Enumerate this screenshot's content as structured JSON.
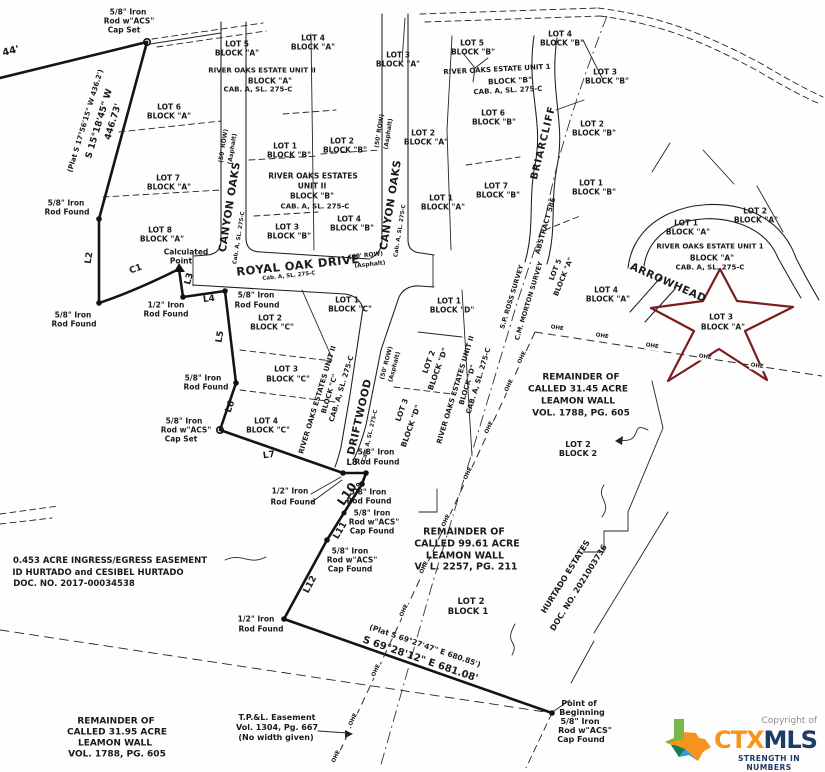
{
  "map": {
    "title": "River Oaks Estates subdivision survey plat",
    "colors": {
      "ink": "#1a1a1a",
      "paper": "#fefefe",
      "star_red": "#7b1c1f",
      "logo_orange": "#f7941e",
      "logo_navy": "#1e3c68",
      "logo_green": "#7ab648",
      "logo_teal": "#177b57",
      "logo_blue": "#2a9fd8",
      "copyright_gray": "#8d8d8d"
    },
    "logo": {
      "copyright": "Copyright of",
      "ctx": "CTX",
      "mls": "MLS",
      "tagline": "STRENGTH IN NUMBERS"
    },
    "labels": [
      {
        "t": "5/8\" Iron",
        "x": 128,
        "y": 12
      },
      {
        "t": "Rod w\"ACS\"",
        "x": 129,
        "y": 21
      },
      {
        "t": "Cap Set",
        "x": 124,
        "y": 30
      },
      {
        "t": "44'",
        "x": 11,
        "y": 52,
        "r": -14,
        "s": 10
      },
      {
        "t": "(Plat S 17°56'15\" W 436.2')",
        "x": 86,
        "y": 121,
        "r": -73,
        "s": 7
      },
      {
        "t": "S 15°18'45\" W",
        "x": 100,
        "y": 124,
        "r": -73,
        "s": 9
      },
      {
        "t": "446.73'",
        "x": 114,
        "y": 122,
        "r": -73,
        "s": 9
      },
      {
        "t": "5/8\" Iron",
        "x": 66,
        "y": 203
      },
      {
        "t": "Rod Found",
        "x": 67,
        "y": 212
      },
      {
        "t": "L2",
        "x": 90,
        "y": 258,
        "r": -82,
        "s": 9
      },
      {
        "t": "5/8\" Iron",
        "x": 73,
        "y": 315
      },
      {
        "t": "Rod Found",
        "x": 74,
        "y": 324
      },
      {
        "t": "C1",
        "x": 136,
        "y": 270,
        "r": -20,
        "s": 9
      },
      {
        "t": "Calculated",
        "x": 186,
        "y": 252
      },
      {
        "t": "Point",
        "x": 181,
        "y": 261
      },
      {
        "t": "L3",
        "x": 190,
        "y": 279,
        "r": -75,
        "s": 9
      },
      {
        "t": "1/2\" Iron",
        "x": 166,
        "y": 305
      },
      {
        "t": "Rod Found",
        "x": 166,
        "y": 314
      },
      {
        "t": "L4",
        "x": 209,
        "y": 300,
        "r": -6,
        "s": 9
      },
      {
        "t": "5/8\" Iron",
        "x": 256,
        "y": 295
      },
      {
        "t": "Rod Found",
        "x": 257,
        "y": 305
      },
      {
        "t": "L5",
        "x": 221,
        "y": 337,
        "r": -80,
        "s": 9
      },
      {
        "t": "5/8\" Iron",
        "x": 203,
        "y": 378
      },
      {
        "t": "Rod Found",
        "x": 206,
        "y": 387
      },
      {
        "t": "L6",
        "x": 231,
        "y": 407,
        "r": -70,
        "s": 9
      },
      {
        "t": "5/8\" Iron",
        "x": 184,
        "y": 421
      },
      {
        "t": "Rod w\"ACS\"",
        "x": 186,
        "y": 430
      },
      {
        "t": "Cap Set",
        "x": 181,
        "y": 439
      },
      {
        "t": "L7",
        "x": 269,
        "y": 456,
        "r": -8,
        "s": 9
      },
      {
        "t": "LOT 5",
        "x": 237,
        "y": 44
      },
      {
        "t": "BLOCK \"A\"",
        "x": 237,
        "y": 53
      },
      {
        "t": "LOT 6",
        "x": 169,
        "y": 107
      },
      {
        "t": "BLOCK \"A\"",
        "x": 169,
        "y": 116
      },
      {
        "t": "LOT 7",
        "x": 168,
        "y": 178
      },
      {
        "t": "BLOCK \"A\"",
        "x": 169,
        "y": 187
      },
      {
        "t": "LOT 8",
        "x": 160,
        "y": 230
      },
      {
        "t": "BLOCK \"A\"",
        "x": 162,
        "y": 239
      },
      {
        "t": "RIVER OAKS ESTATE UNIT II",
        "x": 262,
        "y": 71,
        "s": 7
      },
      {
        "t": "BLOCK \"A\"",
        "x": 270,
        "y": 81
      },
      {
        "t": "CAB. A, SL. 275-C",
        "x": 258,
        "y": 90,
        "s": 7
      },
      {
        "t": "LOT 4",
        "x": 313,
        "y": 38
      },
      {
        "t": "BLOCK \"A\"",
        "x": 313,
        "y": 47
      },
      {
        "t": "LOT 3",
        "x": 398,
        "y": 55
      },
      {
        "t": "BLOCK \"A\"",
        "x": 398,
        "y": 64
      },
      {
        "t": "LOT 2",
        "x": 423,
        "y": 133
      },
      {
        "t": "BLOCK \"A\"",
        "x": 426,
        "y": 142
      },
      {
        "t": "LOT 1",
        "x": 441,
        "y": 198
      },
      {
        "t": "BLOCK \"A\"",
        "x": 443,
        "y": 207
      },
      {
        "t": "LOT 1",
        "x": 285,
        "y": 146
      },
      {
        "t": "BLOCK \"B\"",
        "x": 289,
        "y": 155
      },
      {
        "t": "LOT 2",
        "x": 342,
        "y": 141
      },
      {
        "t": "BLOCK \"B\"",
        "x": 345,
        "y": 150
      },
      {
        "t": "RIVER OAKS ESTATES",
        "x": 313,
        "y": 176,
        "s": 7.5
      },
      {
        "t": "UNIT II",
        "x": 312,
        "y": 186
      },
      {
        "t": "BLOCK \"B\"",
        "x": 312,
        "y": 196
      },
      {
        "t": "CAB. A, SL. 275-C",
        "x": 315,
        "y": 207,
        "s": 7
      },
      {
        "t": "LOT 3",
        "x": 287,
        "y": 227
      },
      {
        "t": "BLOCK \"B\"",
        "x": 289,
        "y": 236
      },
      {
        "t": "LOT 4",
        "x": 349,
        "y": 219
      },
      {
        "t": "BLOCK \"B\"",
        "x": 352,
        "y": 228
      },
      {
        "t": "LOT 5",
        "x": 472,
        "y": 43
      },
      {
        "t": "BLOCK \"B\"",
        "x": 473,
        "y": 52
      },
      {
        "t": "LOT 4",
        "x": 560,
        "y": 34
      },
      {
        "t": "BLOCK \"B\"",
        "x": 562,
        "y": 43
      },
      {
        "t": "RIVER OAKS ESTATE UNIT 1",
        "x": 497,
        "y": 70,
        "r": -3,
        "s": 7
      },
      {
        "t": "BLOCK \"B\"",
        "x": 510,
        "y": 81,
        "r": -3
      },
      {
        "t": "CAB. A, SL. 275-C",
        "x": 508,
        "y": 91,
        "r": -3,
        "s": 7
      },
      {
        "t": "LOT 6",
        "x": 493,
        "y": 113
      },
      {
        "t": "BLOCK \"B\"",
        "x": 494,
        "y": 122
      },
      {
        "t": "LOT 3",
        "x": 605,
        "y": 72
      },
      {
        "t": "BLOCK \"B\"",
        "x": 607,
        "y": 81
      },
      {
        "t": "LOT 2",
        "x": 592,
        "y": 124
      },
      {
        "t": "BLOCK \"B\"",
        "x": 594,
        "y": 133
      },
      {
        "t": "LOT 7",
        "x": 496,
        "y": 186
      },
      {
        "t": "BLOCK \"B\"",
        "x": 498,
        "y": 195
      },
      {
        "t": "LOT 1",
        "x": 591,
        "y": 183
      },
      {
        "t": "BLOCK \"B\"",
        "x": 594,
        "y": 192
      },
      {
        "t": "BRIARCLIFF",
        "x": 544,
        "y": 143,
        "r": -76,
        "s": 10,
        "w": 800,
        "sp": 1
      },
      {
        "t": "ABSTRACT 586",
        "x": 546,
        "y": 226,
        "r": -74,
        "s": 7
      },
      {
        "t": "LOT 2",
        "x": 755,
        "y": 211
      },
      {
        "t": "BLOCK \"A\"",
        "x": 756,
        "y": 220
      },
      {
        "t": "LOT 1",
        "x": 686,
        "y": 223
      },
      {
        "t": "BLOCK \"A\"",
        "x": 688,
        "y": 232
      },
      {
        "t": "RIVER OAKS ESTATE UNIT 1",
        "x": 710,
        "y": 247,
        "s": 7
      },
      {
        "t": "BLOCK \"A\"",
        "x": 712,
        "y": 258
      },
      {
        "t": "CAB. A, SL. 275-C",
        "x": 710,
        "y": 268,
        "s": 7
      },
      {
        "t": "ARROWHEAD",
        "x": 668,
        "y": 283,
        "r": 24,
        "s": 10.5,
        "w": 800,
        "sp": 0.5
      },
      {
        "t": "LOT 4",
        "x": 606,
        "y": 290
      },
      {
        "t": "BLOCK \"A\"",
        "x": 608,
        "y": 299
      },
      {
        "t": "LOT 3",
        "x": 721,
        "y": 317
      },
      {
        "t": "BLOCK \"A\"",
        "x": 723,
        "y": 327
      },
      {
        "t": "LOT 5",
        "x": 556,
        "y": 270,
        "r": -68,
        "s": 7
      },
      {
        "t": "BLOCK \"A\"",
        "x": 564,
        "y": 277,
        "r": -68,
        "s": 7
      },
      {
        "t": "CANYON OAKS",
        "x": 230,
        "y": 207,
        "r": -81,
        "s": 10.5,
        "w": 800,
        "sp": 0.5
      },
      {
        "t": "(50' ROW)",
        "x": 224,
        "y": 146,
        "r": -81,
        "s": 6
      },
      {
        "t": "(Asphalt)",
        "x": 233,
        "y": 149,
        "r": -81,
        "s": 6
      },
      {
        "t": "Cab. A, SL. 275-C",
        "x": 240,
        "y": 238,
        "r": -81,
        "s": 5.5
      },
      {
        "t": "CANYON OAKS",
        "x": 391,
        "y": 205,
        "r": -81,
        "s": 10.5,
        "w": 800,
        "sp": 0.5
      },
      {
        "t": "(50' ROW)",
        "x": 380,
        "y": 131,
        "r": -81,
        "s": 6
      },
      {
        "t": "(Asphalt)",
        "x": 389,
        "y": 134,
        "r": -81,
        "s": 6
      },
      {
        "t": "Cab. A, SL. 275-C",
        "x": 401,
        "y": 231,
        "r": -81,
        "s": 5.5
      },
      {
        "t": "ROYAL OAK DRIVE",
        "x": 298,
        "y": 266,
        "r": -6,
        "s": 11.5,
        "w": 800,
        "sp": 0.5
      },
      {
        "t": "Cab. A, SL. 275-C",
        "x": 289,
        "y": 277,
        "r": -6,
        "s": 5.5
      },
      {
        "t": "(60' ROW)",
        "x": 366,
        "y": 256,
        "r": -6,
        "s": 6
      },
      {
        "t": "(Asphalt)",
        "x": 370,
        "y": 265,
        "r": -6,
        "s": 6
      },
      {
        "t": "DRIFTWOOD",
        "x": 360,
        "y": 417,
        "r": -77,
        "s": 10.5,
        "w": 800,
        "sp": 0.5
      },
      {
        "t": "(50' ROW)",
        "x": 387,
        "y": 363,
        "r": -75,
        "s": 6
      },
      {
        "t": "(Asphalt)",
        "x": 395,
        "y": 367,
        "r": -75,
        "s": 6
      },
      {
        "t": "Cab. A, SL. 275-C",
        "x": 371,
        "y": 436,
        "r": -77,
        "s": 5.5
      },
      {
        "t": "LOT 1",
        "x": 347,
        "y": 300
      },
      {
        "t": "BLOCK \"C\"",
        "x": 350,
        "y": 309
      },
      {
        "t": "LOT 2",
        "x": 270,
        "y": 318
      },
      {
        "t": "BLOCK \"C\"",
        "x": 272,
        "y": 327
      },
      {
        "t": "LOT 3",
        "x": 286,
        "y": 369
      },
      {
        "t": "BLOCK \"C\"",
        "x": 288,
        "y": 379
      },
      {
        "t": "LOT 4",
        "x": 266,
        "y": 421
      },
      {
        "t": "BLOCK \"C\"",
        "x": 268,
        "y": 430
      },
      {
        "t": "RIVER OAKS ESTATES UNIT II",
        "x": 318,
        "y": 400,
        "r": -73,
        "s": 7
      },
      {
        "t": "BLOCK \"C\"",
        "x": 330,
        "y": 394,
        "r": -73,
        "s": 7
      },
      {
        "t": "CAB. A, SL. 275-C",
        "x": 342,
        "y": 389,
        "r": -73,
        "s": 7
      },
      {
        "t": "LOT 1",
        "x": 449,
        "y": 301
      },
      {
        "t": "BLOCK \"D\"",
        "x": 452,
        "y": 310
      },
      {
        "t": "LOT 2",
        "x": 429,
        "y": 362,
        "r": -70
      },
      {
        "t": "BLOCK \"D\"",
        "x": 438,
        "y": 369,
        "r": -70
      },
      {
        "t": "LOT 3",
        "x": 402,
        "y": 410,
        "r": -70
      },
      {
        "t": "BLOCK \"D\"",
        "x": 411,
        "y": 426,
        "r": -70
      },
      {
        "t": "RIVER OAKS ESTATES UNIT II",
        "x": 456,
        "y": 390,
        "r": -73,
        "s": 7
      },
      {
        "t": "BLOCK \"D\"",
        "x": 468,
        "y": 385,
        "r": -73,
        "s": 7
      },
      {
        "t": "CAB. A, SL. 275-C",
        "x": 479,
        "y": 381,
        "r": -73,
        "s": 7
      },
      {
        "t": "S.P. ROSS SURVEY",
        "x": 512,
        "y": 297,
        "r": -73,
        "s": 6.5
      },
      {
        "t": "C.M. MORTON SURVEY",
        "x": 529,
        "y": 301,
        "r": -73,
        "s": 6.5
      },
      {
        "t": "REMAINDER OF",
        "x": 581,
        "y": 378,
        "s": 9
      },
      {
        "t": "CALLED 31.45 ACRE",
        "x": 578,
        "y": 390,
        "s": 9
      },
      {
        "t": "LEAMON WALL",
        "x": 578,
        "y": 402,
        "s": 9
      },
      {
        "t": "VOL. 1788, PG. 605",
        "x": 581,
        "y": 414,
        "s": 9
      },
      {
        "t": "LOT 2",
        "x": 578,
        "y": 445,
        "s": 8
      },
      {
        "t": "BLOCK 2",
        "x": 578,
        "y": 454,
        "s": 8
      },
      {
        "t": "L8",
        "x": 352,
        "y": 463,
        "s": 8.5
      },
      {
        "t": "5/8\" Iron",
        "x": 376,
        "y": 452
      },
      {
        "t": "Rod Found",
        "x": 377,
        "y": 462
      },
      {
        "t": "L9",
        "x": 358,
        "y": 487,
        "r": -60,
        "s": 6.5
      },
      {
        "t": "1/2\" Iron",
        "x": 290,
        "y": 491
      },
      {
        "t": "Rod Found",
        "x": 293,
        "y": 502
      },
      {
        "t": "L10",
        "x": 347,
        "y": 494,
        "r": -56,
        "s": 12
      },
      {
        "t": "5/8\" Iron",
        "x": 368,
        "y": 492
      },
      {
        "t": "Rod Found",
        "x": 369,
        "y": 501
      },
      {
        "t": "5/8\" Iron",
        "x": 372,
        "y": 513
      },
      {
        "t": "Rod w\"ACS\"",
        "x": 374,
        "y": 522
      },
      {
        "t": "Cap Found",
        "x": 372,
        "y": 531
      },
      {
        "t": "L11",
        "x": 341,
        "y": 531,
        "r": -60,
        "s": 9
      },
      {
        "t": "5/8\" Iron",
        "x": 350,
        "y": 551
      },
      {
        "t": "Rod w\"ACS\"",
        "x": 352,
        "y": 560
      },
      {
        "t": "Cap Found",
        "x": 350,
        "y": 569
      },
      {
        "t": "L12",
        "x": 311,
        "y": 585,
        "r": -62,
        "s": 9
      },
      {
        "t": "REMAINDER OF",
        "x": 464,
        "y": 532,
        "s": 9.5
      },
      {
        "t": "CALLED 99.61 ACRE",
        "x": 467,
        "y": 544,
        "s": 9.5
      },
      {
        "t": "LEAMON WALL",
        "x": 465,
        "y": 556,
        "s": 9.5
      },
      {
        "t": "VOL. 2257, PG. 211",
        "x": 466,
        "y": 567,
        "s": 9.5
      },
      {
        "t": "LOT 2",
        "x": 471,
        "y": 602,
        "s": 8.5
      },
      {
        "t": "BLOCK 1",
        "x": 468,
        "y": 612,
        "s": 8.5
      },
      {
        "t": "HURTADO ESTATES",
        "x": 566,
        "y": 577,
        "r": -58,
        "s": 8
      },
      {
        "t": "DOC. NO. 2021003736",
        "x": 579,
        "y": 588,
        "r": -58,
        "s": 8
      },
      {
        "t": "0.453 ACRE INGRESS/EGRESS EASEMENT",
        "x": 110,
        "y": 561,
        "s": 8.5
      },
      {
        "t": "ID HURTADO and CESIBEL HURTADO",
        "x": 98,
        "y": 573,
        "s": 8.5
      },
      {
        "t": "DOC. NO. 2017-00034538",
        "x": 74,
        "y": 584,
        "s": 8.5
      },
      {
        "t": "1/2\" Iron",
        "x": 256,
        "y": 619
      },
      {
        "t": "Rod Found",
        "x": 261,
        "y": 629
      },
      {
        "t": "(Plat S 69°27'47\" E 680.85')",
        "x": 425,
        "y": 646,
        "r": 19,
        "s": 7.5
      },
      {
        "t": "S 69°28'12\" E 681.08'",
        "x": 420,
        "y": 660,
        "r": 19,
        "s": 10
      },
      {
        "t": "T.P.&L. Easement",
        "x": 277,
        "y": 718,
        "s": 8
      },
      {
        "t": "Vol. 1304, Pg. 667",
        "x": 277,
        "y": 728,
        "s": 8
      },
      {
        "t": "(No width given)",
        "x": 276,
        "y": 738,
        "s": 8
      },
      {
        "t": "REMAINDER OF",
        "x": 116,
        "y": 722,
        "s": 9
      },
      {
        "t": "CALLED 31.95 ACRE",
        "x": 117,
        "y": 733,
        "s": 9
      },
      {
        "t": "LEAMON WALL",
        "x": 115,
        "y": 744,
        "s": 9
      },
      {
        "t": "VOL. 1788, PG. 605",
        "x": 117,
        "y": 755,
        "s": 9
      },
      {
        "t": "Point of",
        "x": 579,
        "y": 704,
        "s": 8
      },
      {
        "t": "Beginning",
        "x": 582,
        "y": 713,
        "s": 8
      },
      {
        "t": "5/8\" Iron",
        "x": 580,
        "y": 722,
        "s": 8
      },
      {
        "t": "Rod w\"ACS\"",
        "x": 585,
        "y": 731,
        "s": 8
      },
      {
        "t": "Cap Found",
        "x": 581,
        "y": 740,
        "s": 8
      },
      {
        "t": "OHE",
        "x": 557,
        "y": 329,
        "r": 9,
        "s": 5.5,
        "bg": 1
      },
      {
        "t": "OHE",
        "x": 602,
        "y": 337,
        "r": 9,
        "s": 5.5,
        "bg": 1
      },
      {
        "t": "OHE",
        "x": 652,
        "y": 347,
        "r": 9,
        "s": 5.5,
        "bg": 1
      },
      {
        "t": "OHE",
        "x": 705,
        "y": 358,
        "r": 9,
        "s": 5.5,
        "bg": 1
      },
      {
        "t": "OHE",
        "x": 757,
        "y": 367,
        "r": 9,
        "s": 5.5,
        "bg": 1
      },
      {
        "t": "OHE",
        "x": 523,
        "y": 358,
        "r": -65,
        "s": 5.5,
        "bg": 1
      },
      {
        "t": "OHE",
        "x": 510,
        "y": 386,
        "r": -65,
        "s": 5.5,
        "bg": 1
      },
      {
        "t": "OHE",
        "x": 490,
        "y": 428,
        "r": -65,
        "s": 5.5,
        "bg": 1
      },
      {
        "t": "OHE",
        "x": 469,
        "y": 474,
        "r": -65,
        "s": 5.5,
        "bg": 1
      },
      {
        "t": "OHE",
        "x": 447,
        "y": 521,
        "r": -65,
        "s": 5.5,
        "bg": 1
      },
      {
        "t": "OHE",
        "x": 425,
        "y": 568,
        "r": -65,
        "s": 5.5,
        "bg": 1
      },
      {
        "t": "OHE",
        "x": 405,
        "y": 611,
        "r": -65,
        "s": 5.5,
        "bg": 1
      },
      {
        "t": "OHE",
        "x": 377,
        "y": 671,
        "r": -65,
        "s": 5.5,
        "bg": 1
      },
      {
        "t": "OHE",
        "x": 354,
        "y": 720,
        "r": -65,
        "s": 5.5,
        "bg": 1
      },
      {
        "t": "OHE",
        "x": 337,
        "y": 757,
        "r": -65,
        "s": 5.5,
        "bg": 1
      }
    ]
  }
}
